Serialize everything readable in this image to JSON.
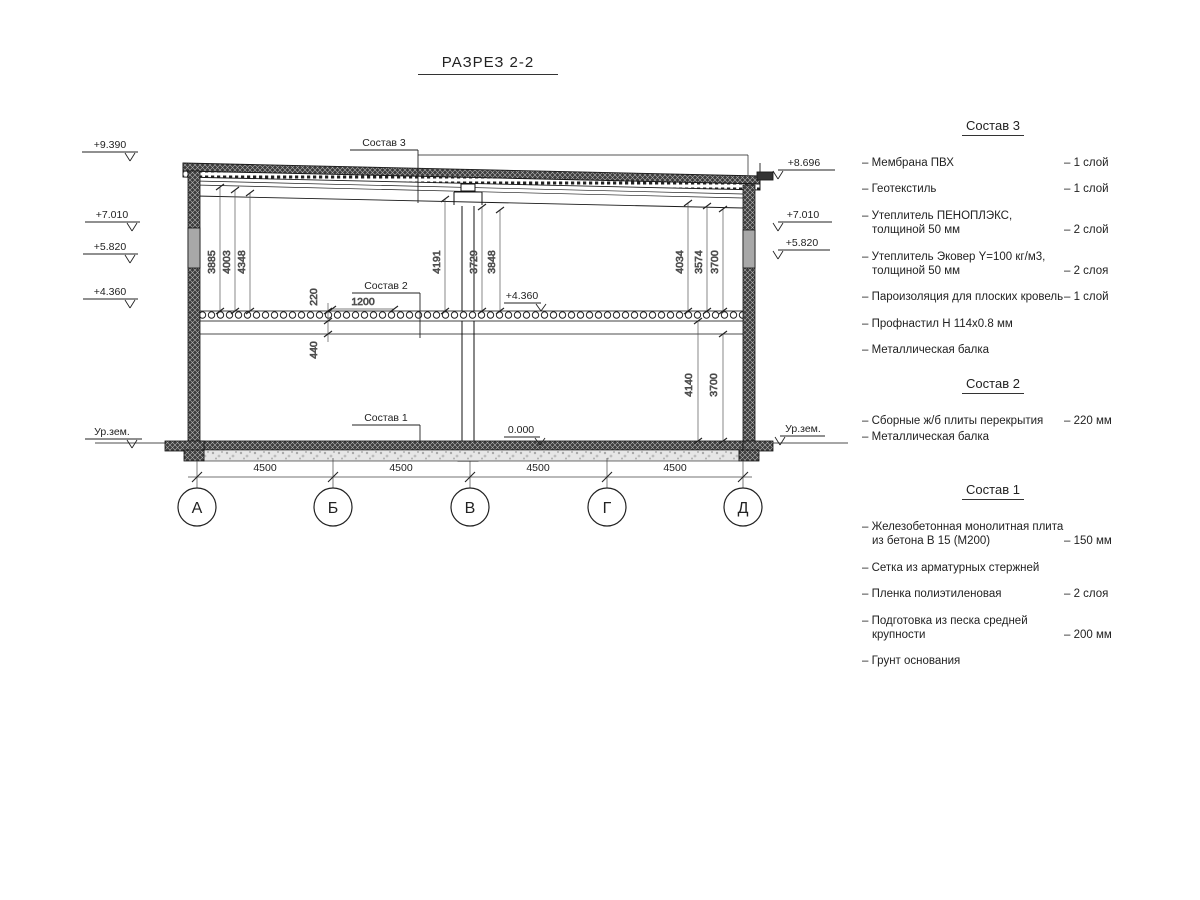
{
  "title": "РАЗРЕЗ 2-2",
  "colors": {
    "ink": "#1a1a1a",
    "background": "#ffffff",
    "window_fill": "#a8a8a8"
  },
  "drawing": {
    "elev_left": [
      "+9.390",
      "+7.010",
      "+5.820",
      "+4.360"
    ],
    "elev_right": [
      "+8.696",
      "+7.010",
      "+5.820"
    ],
    "ground_label": "Ур.зем.",
    "internal_marks": {
      "floor2": "+4.360",
      "ground_floor": "0.000"
    },
    "leaders": [
      "Состав 3",
      "Состав 2",
      "Состав 1"
    ],
    "dims": {
      "upper_left": [
        "3885",
        "4003",
        "4348"
      ],
      "upper_mid": [
        "4191",
        "3729",
        "3848"
      ],
      "upper_right": [
        "4034",
        "3574",
        "3700"
      ],
      "floor": [
        "220",
        "1200",
        "440"
      ],
      "lower_right": [
        "4140",
        "3700"
      ]
    },
    "bottom_dims": [
      "4500",
      "4500",
      "4500",
      "4500"
    ],
    "axes": [
      "А",
      "Б",
      "В",
      "Г",
      "Д"
    ]
  },
  "legends": [
    {
      "header": "Состав 3",
      "items": [
        {
          "name": "– Мембрана ПВХ",
          "qty": "– 1 слой"
        },
        {
          "name": "– Геотекстиль",
          "qty": "– 1 слой"
        },
        {
          "name": "– Утеплитель ПЕНОПЛЭКС, толщиной 50 мм",
          "qty": "– 2 слой"
        },
        {
          "name": "– Утеплитель Эковер Y=100 кг/м3, толщиной 50 мм",
          "qty": "– 2 слоя"
        },
        {
          "name": "– Пароизоляция для плоских кровель",
          "qty": "– 1 слой"
        },
        {
          "name": "– Профнастил Н 114х0.8 мм",
          "qty": ""
        },
        {
          "name": "– Металлическая балка",
          "qty": ""
        }
      ]
    },
    {
      "header": "Состав 2",
      "items": [
        {
          "name": "– Сборные ж/б плиты перекрытия",
          "qty": "– 220 мм"
        },
        {
          "name": "– Металлическая балка",
          "qty": ""
        }
      ]
    },
    {
      "header": "Состав 1",
      "items": [
        {
          "name": "– Железобетонная монолитная плита из бетона В 15 (М200)",
          "qty": "– 150 мм"
        },
        {
          "name": "– Сетка из арматурных стержней",
          "qty": ""
        },
        {
          "name": "– Пленка полиэтиленовая",
          "qty": "– 2 слоя"
        },
        {
          "name": "– Подготовка из песка средней крупности",
          "qty": "– 200 мм"
        },
        {
          "name": "– Грунт основания",
          "qty": ""
        }
      ]
    }
  ]
}
